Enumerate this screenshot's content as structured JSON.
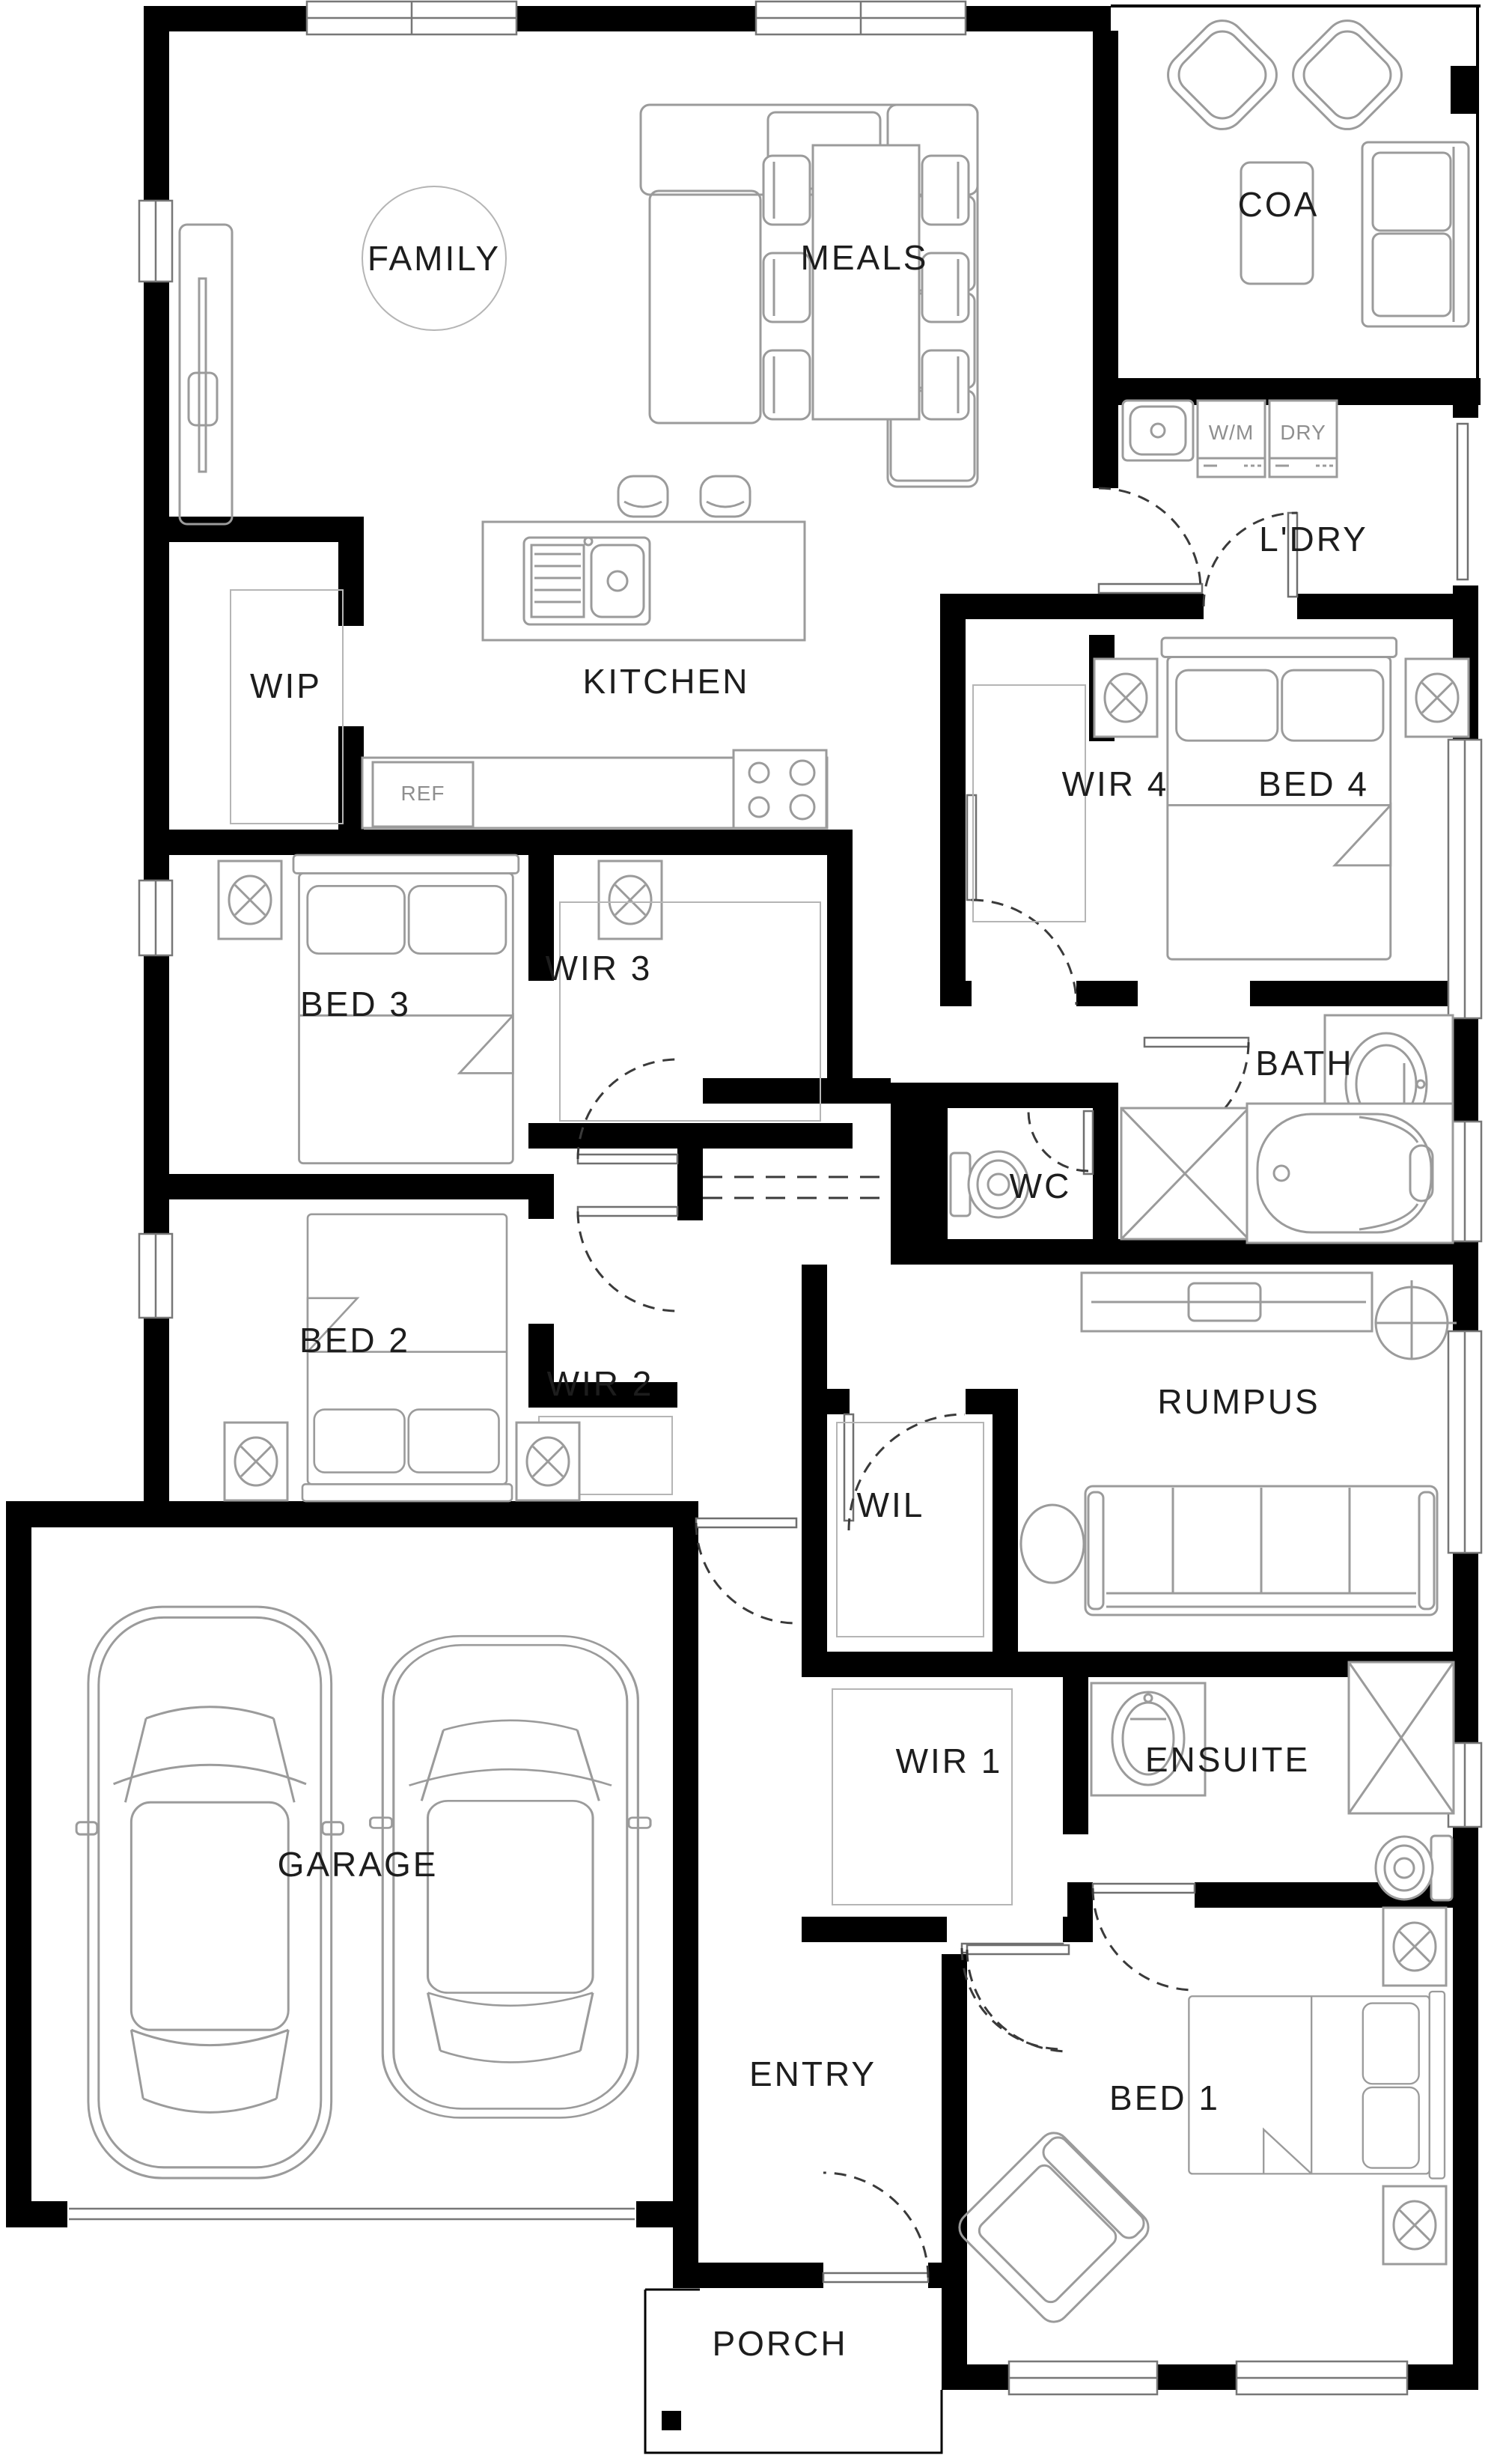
{
  "plan": {
    "rooms": {
      "family": {
        "label": "FAMILY"
      },
      "meals": {
        "label": "MEALS"
      },
      "coa": {
        "label": "COA"
      },
      "ldry": {
        "label": "L'DRY"
      },
      "wip": {
        "label": "WIP"
      },
      "kitchen": {
        "label": "KITCHEN"
      },
      "wir4": {
        "label": "WIR 4"
      },
      "bed4": {
        "label": "BED 4"
      },
      "bed3": {
        "label": "BED 3"
      },
      "wir3": {
        "label": "WIR 3"
      },
      "bath": {
        "label": "BATH"
      },
      "wc": {
        "label": "WC"
      },
      "bed2": {
        "label": "BED 2"
      },
      "wir2": {
        "label": "WIR 2"
      },
      "rumpus": {
        "label": "RUMPUS"
      },
      "wil": {
        "label": "WIL"
      },
      "wir1": {
        "label": "WIR 1"
      },
      "ensuite": {
        "label": "ENSUITE"
      },
      "garage": {
        "label": "GARAGE"
      },
      "entry": {
        "label": "ENTRY"
      },
      "bed1": {
        "label": "BED 1"
      },
      "porch": {
        "label": "PORCH"
      }
    },
    "appliances": {
      "wm": {
        "label": "W/M"
      },
      "dry": {
        "label": "DRY"
      },
      "ref": {
        "label": "REF"
      }
    },
    "colors": {
      "wall": "#000000",
      "furniture": "#9b9b9b",
      "label": "#1d1d1d",
      "appliance": "#8f8f8f",
      "door": "#3a3a3a",
      "window": "#777777",
      "bg": "#ffffff"
    }
  }
}
